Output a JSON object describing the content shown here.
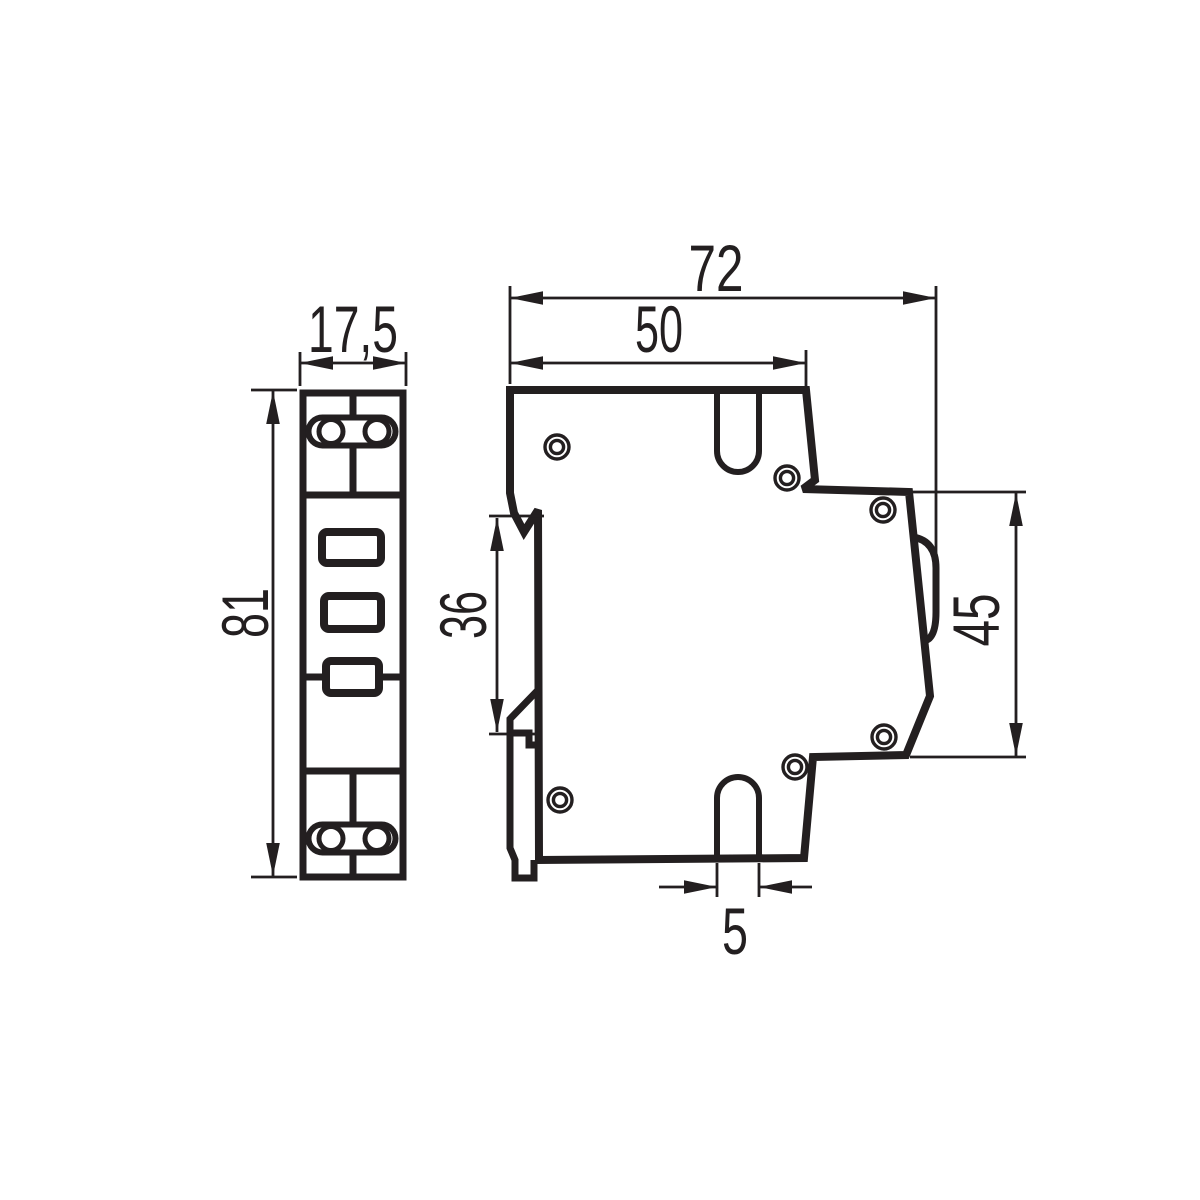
{
  "drawing": {
    "background_color": "#ffffff",
    "line_color": "#231f20",
    "dimension_labels": {
      "front_width": "17,5",
      "front_height": "81",
      "side_overall_depth": "72",
      "side_upper_depth": "50",
      "din_recess_height": "36",
      "side_front_height": "45",
      "mount_slot_width": "5"
    }
  }
}
